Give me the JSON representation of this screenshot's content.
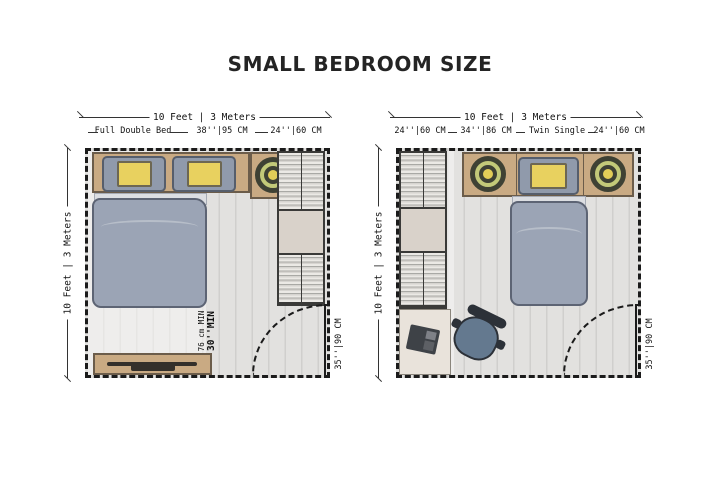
{
  "title": "SMALL BEDROOM SIZE",
  "plans": {
    "left": {
      "name": "Full Double Bed room",
      "top_dimension": "10 Feet | 3 Meters",
      "side_dimension": "10 Feet | 3 Meters",
      "label_bed": "Full Double Bed",
      "label_clearance": "38''|95 CM",
      "label_wardrobe": "24''|60 CM",
      "clearance_metric": "76 cm MIN",
      "clearance_imperial": "30''MIN",
      "door_width": "35''|90 CM"
    },
    "right": {
      "name": "Twin Single room",
      "top_dimension": "10 Feet | 3 Meters",
      "side_dimension": "10 Feet | 3 Meters",
      "label_wardrobe": "24''|60 CM",
      "label_desk": "34''|86 CM",
      "label_bed": "Twin Single",
      "label_nightstand": "24''|60 CM",
      "door_width": "35''|90 CM"
    }
  },
  "colors": {
    "wood": "#c9aa83",
    "cushion_yellow": "#e8d15f",
    "duvet_blue": "#9ba4b5",
    "pillow_gray": "#909aab",
    "floor_gray": "#e2e1df",
    "wall_black": "#1b1b1b",
    "plant_green": "#c2c979",
    "chair_blue": "#64798f"
  }
}
